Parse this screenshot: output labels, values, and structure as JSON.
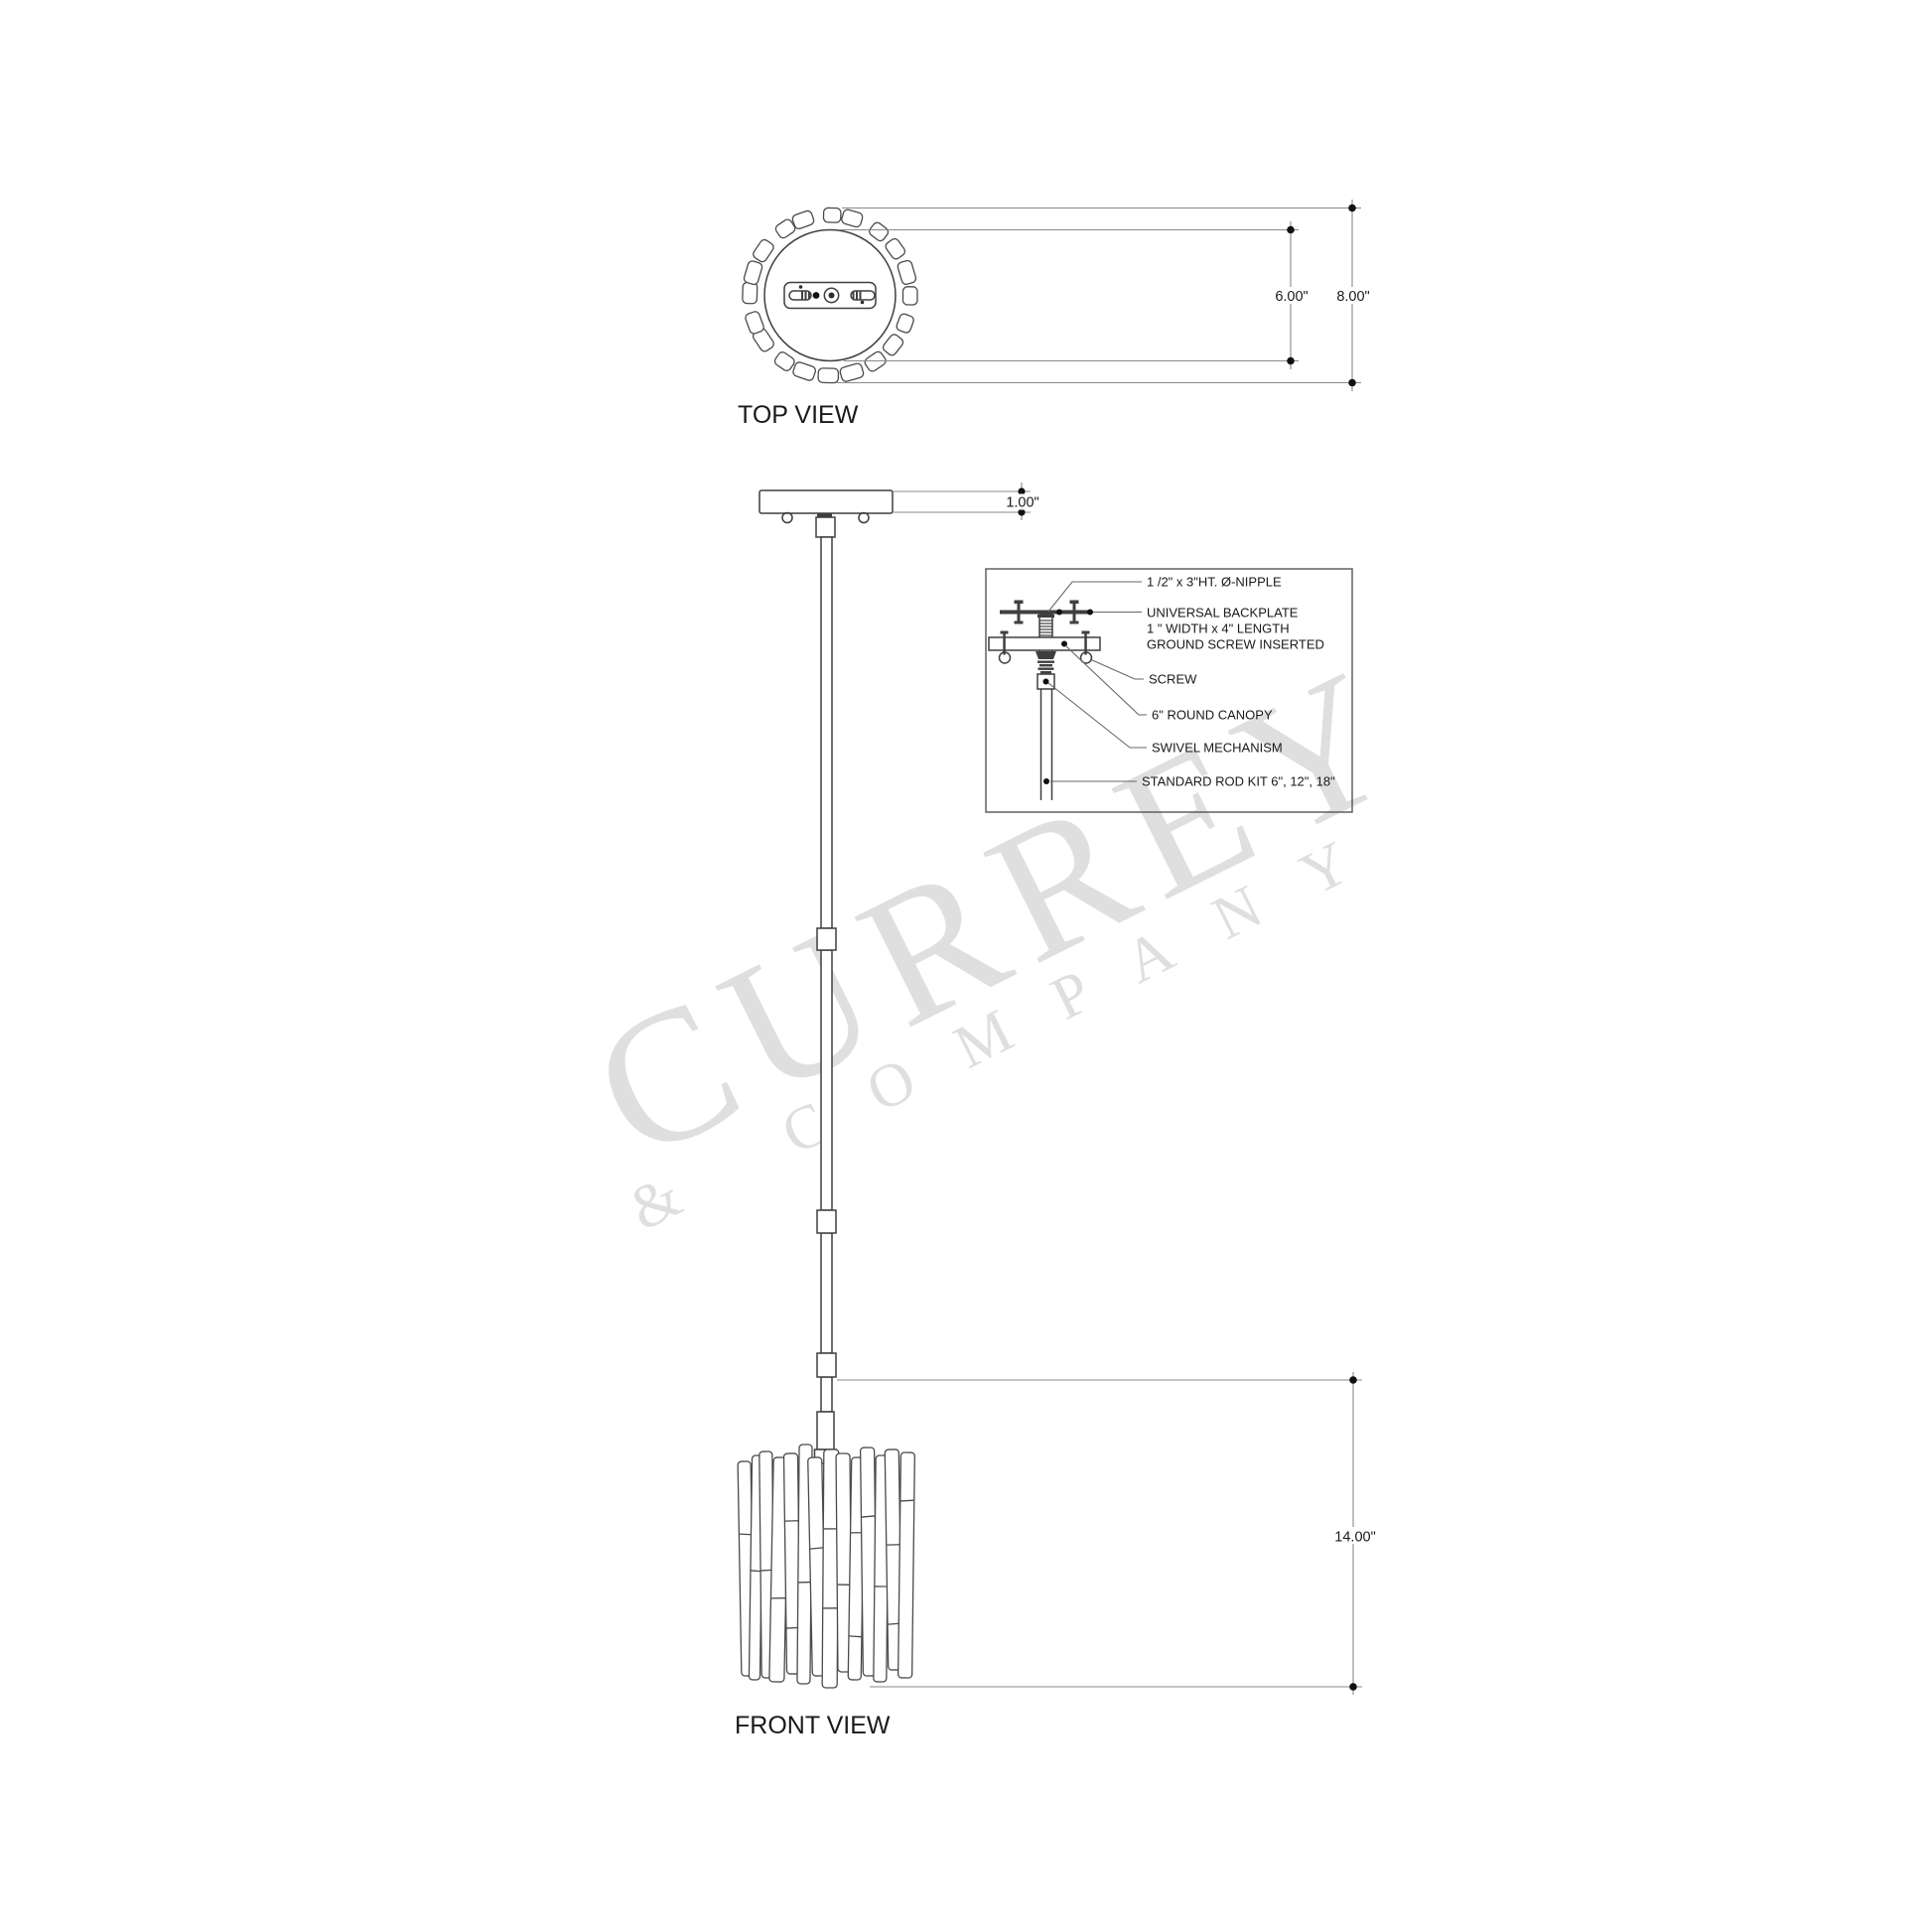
{
  "colors": {
    "line": "#3f3f3f",
    "dimension_line": "#8a8a8a",
    "terminator_dot": "#111111",
    "watermark": "#dfdfdf",
    "background": "#ffffff",
    "text": "#1a1a1a"
  },
  "watermark": {
    "primary": "CURREY",
    "secondary": "& COMPANY"
  },
  "top_view": {
    "title": "TOP VIEW",
    "dims": {
      "inner_diameter": "6.00\"",
      "outer_diameter": "8.00\""
    }
  },
  "front_view": {
    "title": "FRONT VIEW",
    "dims": {
      "canopy_height": "1.00\"",
      "shade_height": "14.00\""
    }
  },
  "detail_inset": {
    "callouts": [
      {
        "id": "nipple",
        "text": "1 /2\" x 3\"HT. Ø-NIPPLE"
      },
      {
        "id": "backplate",
        "lines": [
          "UNIVERSAL BACKPLATE",
          "1 \" WIDTH x 4\" LENGTH",
          "GROUND SCREW INSERTED"
        ]
      },
      {
        "id": "screw",
        "text": "SCREW"
      },
      {
        "id": "canopy",
        "text": "6\" ROUND CANOPY"
      },
      {
        "id": "swivel",
        "text": "SWIVEL MECHANISM"
      },
      {
        "id": "rod_kit",
        "text": "STANDARD ROD KIT 6\", 12\", 18\""
      }
    ]
  }
}
